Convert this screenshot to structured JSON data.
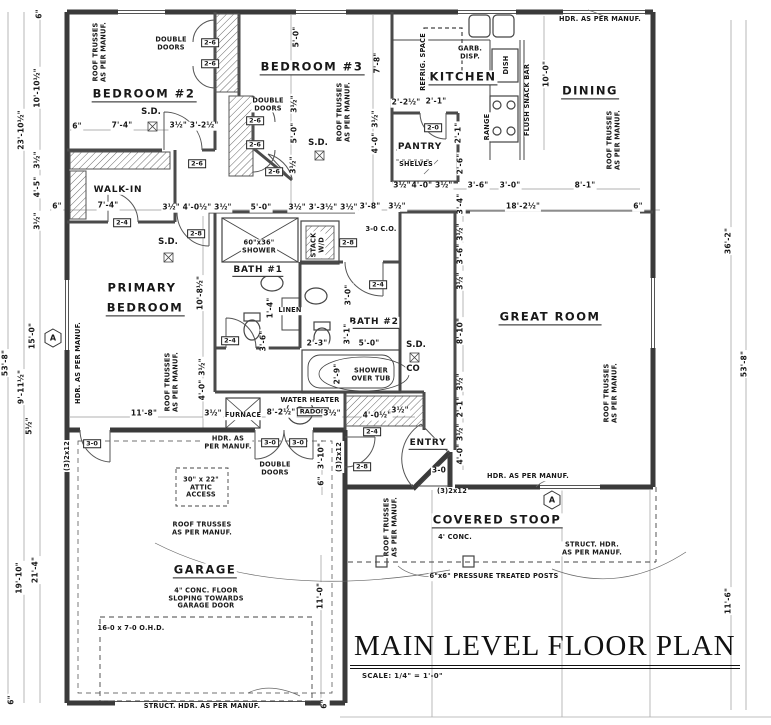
{
  "title": {
    "text": "MAIN LEVEL FLOOR PLAN",
    "scale": "SCALE: 1/4\" = 1'-0\""
  },
  "colors": {
    "ink": "#1c1c1c",
    "wall": "#3a3a3a",
    "dimline": "#888888",
    "paper": "#ffffff"
  },
  "labels": [
    {
      "t": "BEDROOM #2",
      "x": 144,
      "y": 95,
      "k": "room",
      "u": 1,
      "n": "room-label-bedroom-2"
    },
    {
      "t": "BEDROOM #3",
      "x": 312,
      "y": 68,
      "k": "room",
      "u": 1,
      "n": "room-label-bedroom-3"
    },
    {
      "t": "KITCHEN",
      "x": 463,
      "y": 78,
      "k": "room",
      "u": 1,
      "n": "room-label-kitchen"
    },
    {
      "t": "DINING",
      "x": 590,
      "y": 92,
      "k": "room",
      "u": 1,
      "n": "room-label-dining"
    },
    {
      "t": "PANTRY",
      "x": 420,
      "y": 147,
      "k": "room2",
      "n": "room-label-pantry"
    },
    {
      "t": "WALK-IN",
      "x": 118,
      "y": 190,
      "k": "room2",
      "n": "room-label-walk-in"
    },
    {
      "t": "PRIMARY",
      "x": 142,
      "y": 288,
      "k": "room",
      "n": "room-label-primary-bedroom"
    },
    {
      "t": "BEDROOM",
      "x": 145,
      "y": 309,
      "k": "room",
      "u": 1,
      "n": "room-label-primary-bedroom-2"
    },
    {
      "t": "BATH #1",
      "x": 258,
      "y": 271,
      "k": "room2",
      "u": 1,
      "n": "room-label-bath-1"
    },
    {
      "t": "BATH #2",
      "x": 374,
      "y": 323,
      "k": "room2",
      "u": 1,
      "n": "room-label-bath-2"
    },
    {
      "t": "GREAT ROOM",
      "x": 550,
      "y": 318,
      "k": "room",
      "u": 1,
      "n": "room-label-great-room"
    },
    {
      "t": "ENTRY",
      "x": 428,
      "y": 444,
      "k": "room2",
      "u": 1,
      "n": "room-label-entry"
    },
    {
      "t": "COVERED STOOP",
      "x": 497,
      "y": 521,
      "k": "room",
      "u": 1,
      "n": "room-label-covered-stoop"
    },
    {
      "t": "GARAGE",
      "x": 205,
      "y": 571,
      "k": "room",
      "u": 1,
      "n": "room-label-garage"
    },
    {
      "t": "ROOF TRUSSES\nAS PER MANUF.",
      "x": 100,
      "y": 52,
      "k": "note",
      "r": -90
    },
    {
      "t": "ROOF TRUSSES\nAS PER MANUF.",
      "x": 344,
      "y": 112,
      "k": "note",
      "r": -90
    },
    {
      "t": "ROOF TRUSSES\nAS PER MANUF.",
      "x": 614,
      "y": 140,
      "k": "note",
      "r": -90
    },
    {
      "t": "ROOF TRUSSES\nAS PER MANUF.",
      "x": 172,
      "y": 382,
      "k": "note",
      "r": -90
    },
    {
      "t": "ROOF TRUSSES\nAS PER MANUF.",
      "x": 611,
      "y": 393,
      "k": "note",
      "r": -90
    },
    {
      "t": "ROOF TRUSSES\nAS PER MANUF.",
      "x": 391,
      "y": 527,
      "k": "note",
      "r": -90
    },
    {
      "t": "ROOF TRUSSES\nAS PER MANUF.",
      "x": 202,
      "y": 529,
      "k": "note"
    },
    {
      "t": "HDR. AS PER MANUF.",
      "x": 600,
      "y": 20,
      "k": "note"
    },
    {
      "t": "HDR. AS PER MANUF.",
      "x": 79,
      "y": 363,
      "k": "note",
      "r": -90
    },
    {
      "t": "HDR. AS\nPER MANUF.",
      "x": 228,
      "y": 443,
      "k": "note"
    },
    {
      "t": "HDR. AS PER MANUF.",
      "x": 528,
      "y": 477,
      "k": "note"
    },
    {
      "t": "STRUCT. HDR.\nAS PER MANUF.",
      "x": 592,
      "y": 549,
      "k": "note"
    },
    {
      "t": "STRUCT. HDR. AS PER MANUF.",
      "x": 202,
      "y": 707,
      "k": "note"
    },
    {
      "t": "DOUBLE\nDOORS",
      "x": 171,
      "y": 44,
      "k": "note"
    },
    {
      "t": "DOUBLE\nDOORS",
      "x": 268,
      "y": 105,
      "k": "note"
    },
    {
      "t": "DOUBLE\nDOORS",
      "x": 275,
      "y": 469,
      "k": "note"
    },
    {
      "t": "GARB.\nDISP.",
      "x": 470,
      "y": 53,
      "k": "note"
    },
    {
      "t": "REFRIG. SPACE",
      "x": 424,
      "y": 62,
      "k": "note",
      "r": -90
    },
    {
      "t": "DISH",
      "x": 507,
      "y": 65,
      "k": "note",
      "r": -90
    },
    {
      "t": "RANGE",
      "x": 488,
      "y": 127,
      "k": "note",
      "r": -90
    },
    {
      "t": "FLUSH SNACK BAR",
      "x": 528,
      "y": 100,
      "k": "note",
      "r": -90
    },
    {
      "t": "SHELVES",
      "x": 416,
      "y": 165,
      "k": "note"
    },
    {
      "t": "60\"x36\"\nSHOWER",
      "x": 259,
      "y": 247,
      "k": "note"
    },
    {
      "t": "STACK\nW/D",
      "x": 318,
      "y": 245,
      "k": "note",
      "r": -90
    },
    {
      "t": "LINEN",
      "x": 290,
      "y": 311,
      "k": "note"
    },
    {
      "t": "SHOWER\nOVER TUB",
      "x": 371,
      "y": 375,
      "k": "note"
    },
    {
      "t": "WATER HEATER",
      "x": 310,
      "y": 401,
      "k": "note"
    },
    {
      "t": "FURNACE",
      "x": 243,
      "y": 416,
      "k": "note"
    },
    {
      "t": "3-0 C.O.",
      "x": 381,
      "y": 230,
      "k": "note"
    },
    {
      "t": "30\" x 22\"\nATTIC\nACCESS",
      "x": 201,
      "y": 488,
      "k": "note"
    },
    {
      "t": "4\" CONC. FLOOR\nSLOPING TOWARDS\nGARAGE DOOR",
      "x": 206,
      "y": 599,
      "k": "note"
    },
    {
      "t": "16-0 x 7-0 O.H.D.",
      "x": 131,
      "y": 629,
      "k": "note"
    },
    {
      "t": "4' CONC.",
      "x": 455,
      "y": 538,
      "k": "note"
    },
    {
      "t": "6\"x6\" PRESSURE TREATED POSTS",
      "x": 494,
      "y": 577,
      "k": "note"
    },
    {
      "t": "(3)2x12",
      "x": 68,
      "y": 456,
      "k": "note",
      "r": -90
    },
    {
      "t": "(3)2x12",
      "x": 340,
      "y": 457,
      "k": "note",
      "r": -90
    },
    {
      "t": "(3)2x12",
      "x": 452,
      "y": 492,
      "k": "note"
    },
    {
      "t": "S.D.",
      "x": 151,
      "y": 113,
      "k": "sd"
    },
    {
      "t": "S.D.",
      "x": 318,
      "y": 144,
      "k": "sd"
    },
    {
      "t": "S.D.",
      "x": 168,
      "y": 243,
      "k": "sd"
    },
    {
      "t": "S.D.",
      "x": 416,
      "y": 346,
      "k": "sd"
    },
    {
      "t": "CO",
      "x": 413,
      "y": 370,
      "k": "sd"
    },
    {
      "t": "2-6",
      "x": 210,
      "y": 43,
      "k": "tag"
    },
    {
      "t": "2-6",
      "x": 210,
      "y": 64,
      "k": "tag"
    },
    {
      "t": "2-6",
      "x": 255,
      "y": 121,
      "k": "tag"
    },
    {
      "t": "2-6",
      "x": 255,
      "y": 145,
      "k": "tag"
    },
    {
      "t": "2-6",
      "x": 197,
      "y": 164,
      "k": "tag"
    },
    {
      "t": "2-6",
      "x": 274,
      "y": 172,
      "k": "tag"
    },
    {
      "t": "2-4",
      "x": 122,
      "y": 223,
      "k": "tag"
    },
    {
      "t": "2-4",
      "x": 230,
      "y": 341,
      "k": "tag"
    },
    {
      "t": "2-4",
      "x": 378,
      "y": 285,
      "k": "tag"
    },
    {
      "t": "2-4",
      "x": 372,
      "y": 432,
      "k": "tag"
    },
    {
      "t": "2-8",
      "x": 196,
      "y": 234,
      "k": "tag"
    },
    {
      "t": "2-8",
      "x": 348,
      "y": 243,
      "k": "tag"
    },
    {
      "t": "2-8",
      "x": 362,
      "y": 467,
      "k": "tag"
    },
    {
      "t": "2-0",
      "x": 433,
      "y": 128,
      "k": "tag"
    },
    {
      "t": "3-0",
      "x": 92,
      "y": 444,
      "k": "tag"
    },
    {
      "t": "3-0",
      "x": 270,
      "y": 443,
      "k": "tag"
    },
    {
      "t": "3-0",
      "x": 298,
      "y": 443,
      "k": "tag"
    },
    {
      "t": "3-0",
      "x": 439,
      "y": 471,
      "k": "dim"
    },
    {
      "t": "RADON",
      "x": 313,
      "y": 412,
      "k": "tag"
    },
    {
      "t": "A",
      "x": 53,
      "y": 338,
      "k": "marker"
    },
    {
      "t": "A",
      "x": 552,
      "y": 500,
      "k": "marker"
    },
    {
      "t": "6\"",
      "x": 77,
      "y": 127,
      "k": "dim"
    },
    {
      "t": "7'-4\"",
      "x": 122,
      "y": 126,
      "k": "dim"
    },
    {
      "t": "3½\" 3'-2½\"",
      "x": 194,
      "y": 126,
      "k": "dim"
    },
    {
      "t": "5'-0\"",
      "x": 297,
      "y": 37,
      "k": "dim",
      "r": -90
    },
    {
      "t": "3½\"",
      "x": 295,
      "y": 104,
      "k": "dim",
      "r": -90
    },
    {
      "t": "5'-0\"",
      "x": 295,
      "y": 133,
      "k": "dim",
      "r": -90
    },
    {
      "t": "3½\"",
      "x": 294,
      "y": 165,
      "k": "dim",
      "r": -90
    },
    {
      "t": "7'-8\"",
      "x": 378,
      "y": 63,
      "k": "dim",
      "r": -90
    },
    {
      "t": "3½\"",
      "x": 376,
      "y": 119,
      "k": "dim",
      "r": -90
    },
    {
      "t": "4'-0\"",
      "x": 376,
      "y": 143,
      "k": "dim",
      "r": -90
    },
    {
      "t": "2'-2½\"",
      "x": 406,
      "y": 103,
      "k": "dim"
    },
    {
      "t": "2'-1\"",
      "x": 436,
      "y": 102,
      "k": "dim"
    },
    {
      "t": "2'-1\"",
      "x": 459,
      "y": 133,
      "k": "dim",
      "r": -90
    },
    {
      "t": "2'-6\"",
      "x": 461,
      "y": 164,
      "k": "dim",
      "r": -90
    },
    {
      "t": "10'-0\"",
      "x": 547,
      "y": 74,
      "k": "dim",
      "r": -90
    },
    {
      "t": "3½\"",
      "x": 402,
      "y": 186,
      "k": "dim"
    },
    {
      "t": "4'-0\" 3½\"",
      "x": 432,
      "y": 186,
      "k": "dim"
    },
    {
      "t": "3'-6\"",
      "x": 478,
      "y": 186,
      "k": "dim"
    },
    {
      "t": "3'-0\"",
      "x": 510,
      "y": 186,
      "k": "dim"
    },
    {
      "t": "8'-1\"",
      "x": 585,
      "y": 186,
      "k": "dim"
    },
    {
      "t": "3'-4\"",
      "x": 461,
      "y": 204,
      "k": "dim",
      "r": -90
    },
    {
      "t": "6\"",
      "x": 57,
      "y": 207,
      "k": "dim"
    },
    {
      "t": "7'-4\"",
      "x": 108,
      "y": 206,
      "k": "dim"
    },
    {
      "t": "3½\" 4'-0½\" 3½\"",
      "x": 197,
      "y": 208,
      "k": "dim"
    },
    {
      "t": "5'-0\"",
      "x": 261,
      "y": 208,
      "k": "dim"
    },
    {
      "t": "3½\" 3'-3½\" 3½\"",
      "x": 323,
      "y": 208,
      "k": "dim"
    },
    {
      "t": "3'-8\"",
      "x": 370,
      "y": 207,
      "k": "dim"
    },
    {
      "t": "3½\"",
      "x": 397,
      "y": 207,
      "k": "dim"
    },
    {
      "t": "18'-2½\"",
      "x": 523,
      "y": 207,
      "k": "dim"
    },
    {
      "t": "6\"",
      "x": 638,
      "y": 207,
      "k": "dim"
    },
    {
      "t": "53'-8\"",
      "x": 6,
      "y": 363,
      "k": "dim",
      "r": -90
    },
    {
      "t": "23'-10½\"",
      "x": 22,
      "y": 130,
      "k": "dim",
      "r": -90
    },
    {
      "t": "9'-11½\"",
      "x": 22,
      "y": 387,
      "k": "dim",
      "r": -90
    },
    {
      "t": "19'-10\"",
      "x": 20,
      "y": 578,
      "k": "dim",
      "r": -90
    },
    {
      "t": "6\"",
      "x": 40,
      "y": 14,
      "k": "dim",
      "r": -90
    },
    {
      "t": "10'-10½\"",
      "x": 38,
      "y": 88,
      "k": "dim",
      "r": -90
    },
    {
      "t": "3½\"",
      "x": 38,
      "y": 160,
      "k": "dim",
      "r": -90
    },
    {
      "t": "4'-5\"",
      "x": 38,
      "y": 187,
      "k": "dim",
      "r": -90
    },
    {
      "t": "3½\"",
      "x": 38,
      "y": 221,
      "k": "dim",
      "r": -90
    },
    {
      "t": "15'-0\"",
      "x": 33,
      "y": 336,
      "k": "dim",
      "r": -90
    },
    {
      "t": "5½\"",
      "x": 30,
      "y": 426,
      "k": "dim",
      "r": -90
    },
    {
      "t": "21'-4\"",
      "x": 36,
      "y": 570,
      "k": "dim",
      "r": -90
    },
    {
      "t": "6\"",
      "x": 12,
      "y": 700,
      "k": "dim",
      "r": -90
    },
    {
      "t": "36'-2\"",
      "x": 729,
      "y": 241,
      "k": "dim",
      "r": -90
    },
    {
      "t": "53'-8\"",
      "x": 745,
      "y": 364,
      "k": "dim",
      "r": -90
    },
    {
      "t": "11'-6\"",
      "x": 729,
      "y": 601,
      "k": "dim",
      "r": -90
    },
    {
      "t": "10'-8½\"",
      "x": 201,
      "y": 293,
      "k": "dim",
      "r": -90
    },
    {
      "t": "3½\"",
      "x": 203,
      "y": 367,
      "k": "dim",
      "r": -90
    },
    {
      "t": "4'-0\"",
      "x": 203,
      "y": 390,
      "k": "dim",
      "r": -90
    },
    {
      "t": "11'-8\"",
      "x": 144,
      "y": 414,
      "k": "dim"
    },
    {
      "t": "3½\"",
      "x": 213,
      "y": 414,
      "k": "dim"
    },
    {
      "t": "8'-2½\"",
      "x": 281,
      "y": 413,
      "k": "dim"
    },
    {
      "t": "3½\"",
      "x": 332,
      "y": 414,
      "k": "dim"
    },
    {
      "t": "4'-0½\"",
      "x": 377,
      "y": 416,
      "k": "dim"
    },
    {
      "t": "3½\"",
      "x": 400,
      "y": 411,
      "k": "dim"
    },
    {
      "t": "1'-4\"",
      "x": 271,
      "y": 308,
      "k": "dim",
      "r": -90
    },
    {
      "t": "3'-6\"",
      "x": 264,
      "y": 341,
      "k": "dim",
      "r": -90
    },
    {
      "t": "3'-0\"",
      "x": 349,
      "y": 295,
      "k": "dim",
      "r": -90
    },
    {
      "t": "3'-1\"",
      "x": 348,
      "y": 334,
      "k": "dim",
      "r": -90
    },
    {
      "t": "2'-3\"",
      "x": 317,
      "y": 344,
      "k": "dim"
    },
    {
      "t": "5'-0\"",
      "x": 369,
      "y": 344,
      "k": "dim"
    },
    {
      "t": "2'-9\"",
      "x": 338,
      "y": 374,
      "k": "dim",
      "r": -90
    },
    {
      "t": "3½\"",
      "x": 461,
      "y": 232,
      "k": "dim",
      "r": -90
    },
    {
      "t": "3'-6\"",
      "x": 461,
      "y": 254,
      "k": "dim",
      "r": -90
    },
    {
      "t": "3½\"",
      "x": 461,
      "y": 281,
      "k": "dim",
      "r": -90
    },
    {
      "t": "8'-10\"",
      "x": 461,
      "y": 331,
      "k": "dim",
      "r": -90
    },
    {
      "t": "3½\"",
      "x": 461,
      "y": 382,
      "k": "dim",
      "r": -90
    },
    {
      "t": "2'-1\"",
      "x": 461,
      "y": 407,
      "k": "dim",
      "r": -90
    },
    {
      "t": "4'-0\" 3½\"",
      "x": 461,
      "y": 444,
      "k": "dim",
      "r": -90
    },
    {
      "t": "3'-10\"",
      "x": 322,
      "y": 456,
      "k": "dim",
      "r": -90
    },
    {
      "t": "6\"",
      "x": 322,
      "y": 481,
      "k": "dim",
      "r": -90
    },
    {
      "t": "11'-0\"",
      "x": 321,
      "y": 596,
      "k": "dim",
      "r": -90
    },
    {
      "t": "6\"",
      "x": 325,
      "y": 704,
      "k": "dim",
      "r": -90
    }
  ]
}
